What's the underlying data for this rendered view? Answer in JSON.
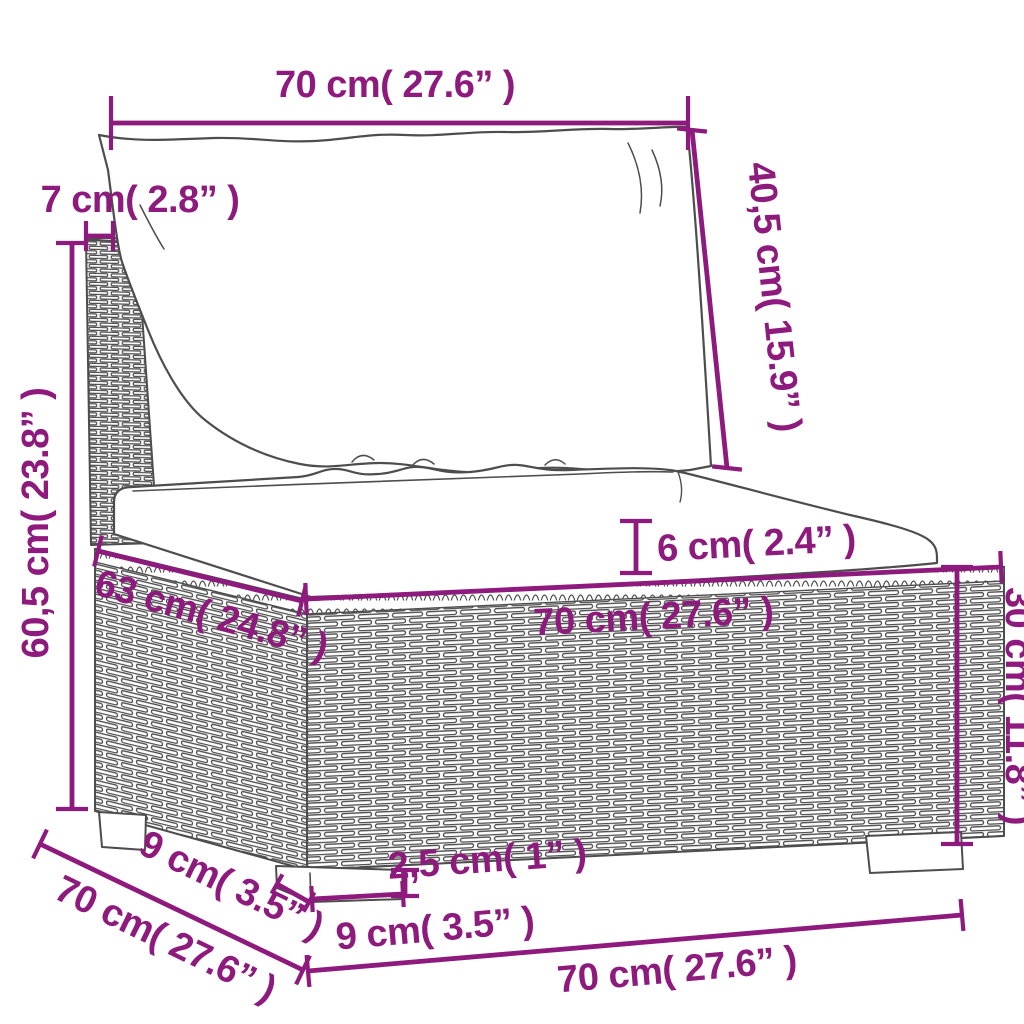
{
  "diagram": {
    "description": "Sofa section dimension diagram",
    "colors": {
      "dimension_purple": "#8d1a7c",
      "line_gray": "#4d4d4d",
      "background": "#ffffff"
    },
    "labels": {
      "top_width": "70 cm( 27.6” )",
      "back_post_width": "7 cm( 2.8” )",
      "back_cushion_height": "40,5 cm( 15.9” )",
      "total_height": "60,5 cm( 23.8” )",
      "seat_cushion_thickness": "6 cm( 2.4” )",
      "seat_depth": "63 cm( 24.8” )",
      "seat_width": "70 cm( 27.6” )",
      "base_height": "30 cm( 11.8” )",
      "side_depth": "70 cm( 27.6” )",
      "foot_depth": "9 cm( 3.5” )",
      "foot_height": "2,5 cm( 1” )",
      "foot_width": "9 cm( 3.5” )",
      "base_width": "70 cm( 27.6” )"
    }
  }
}
